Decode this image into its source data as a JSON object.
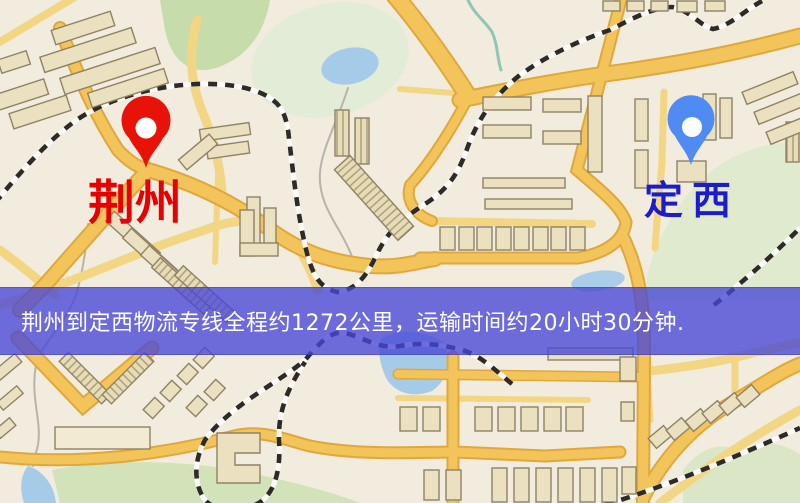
{
  "map_overlay": {
    "banner_text": "荆州到定西物流专线全程约1272公里，运输时间约20小时30分钟.",
    "origin_label": "荆州",
    "destination_label": "定西"
  },
  "route_info": {
    "origin": "荆州",
    "destination": "定西",
    "service": "物流专线",
    "distance": "约1272公里",
    "duration": "约20小时30分钟"
  },
  "icons": {
    "origin_pin": "red-map-pin",
    "destination_pin": "blue-map-pin"
  },
  "colors": {
    "map_bg": "#f1ecdd",
    "road": "#f3c45a",
    "water": "#a6cbe9",
    "park": "#d6e5bd",
    "building": "#ebe0bf",
    "railway": "#2e2a26",
    "banner": "rgba(72,70,215,0.78)",
    "origin_text": "#e60000",
    "destination_text": "#1c1ccd",
    "origin_pin": "#e81209",
    "destination_pin": "#4f8bf2"
  }
}
